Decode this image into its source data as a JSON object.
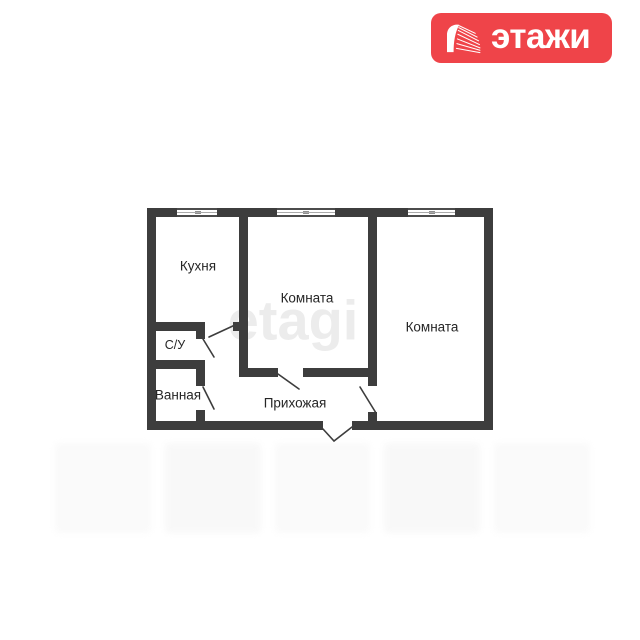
{
  "logo": {
    "text": "этажи",
    "background_color": "#ef4449",
    "icon": "etagi-building-icon"
  },
  "watermark": {
    "center_text": "etagi"
  },
  "floor_plan": {
    "wall_color": "#3d3d3d",
    "rooms": [
      {
        "id": "kitchen",
        "label": "Кухня"
      },
      {
        "id": "room-1",
        "label": "Комната"
      },
      {
        "id": "room-2",
        "label": "Комната"
      },
      {
        "id": "wc",
        "label": "С/У"
      },
      {
        "id": "bathroom",
        "label": "Ванная"
      },
      {
        "id": "hallway",
        "label": "Прихожая"
      }
    ],
    "window_count": 3,
    "door_count": 6
  }
}
